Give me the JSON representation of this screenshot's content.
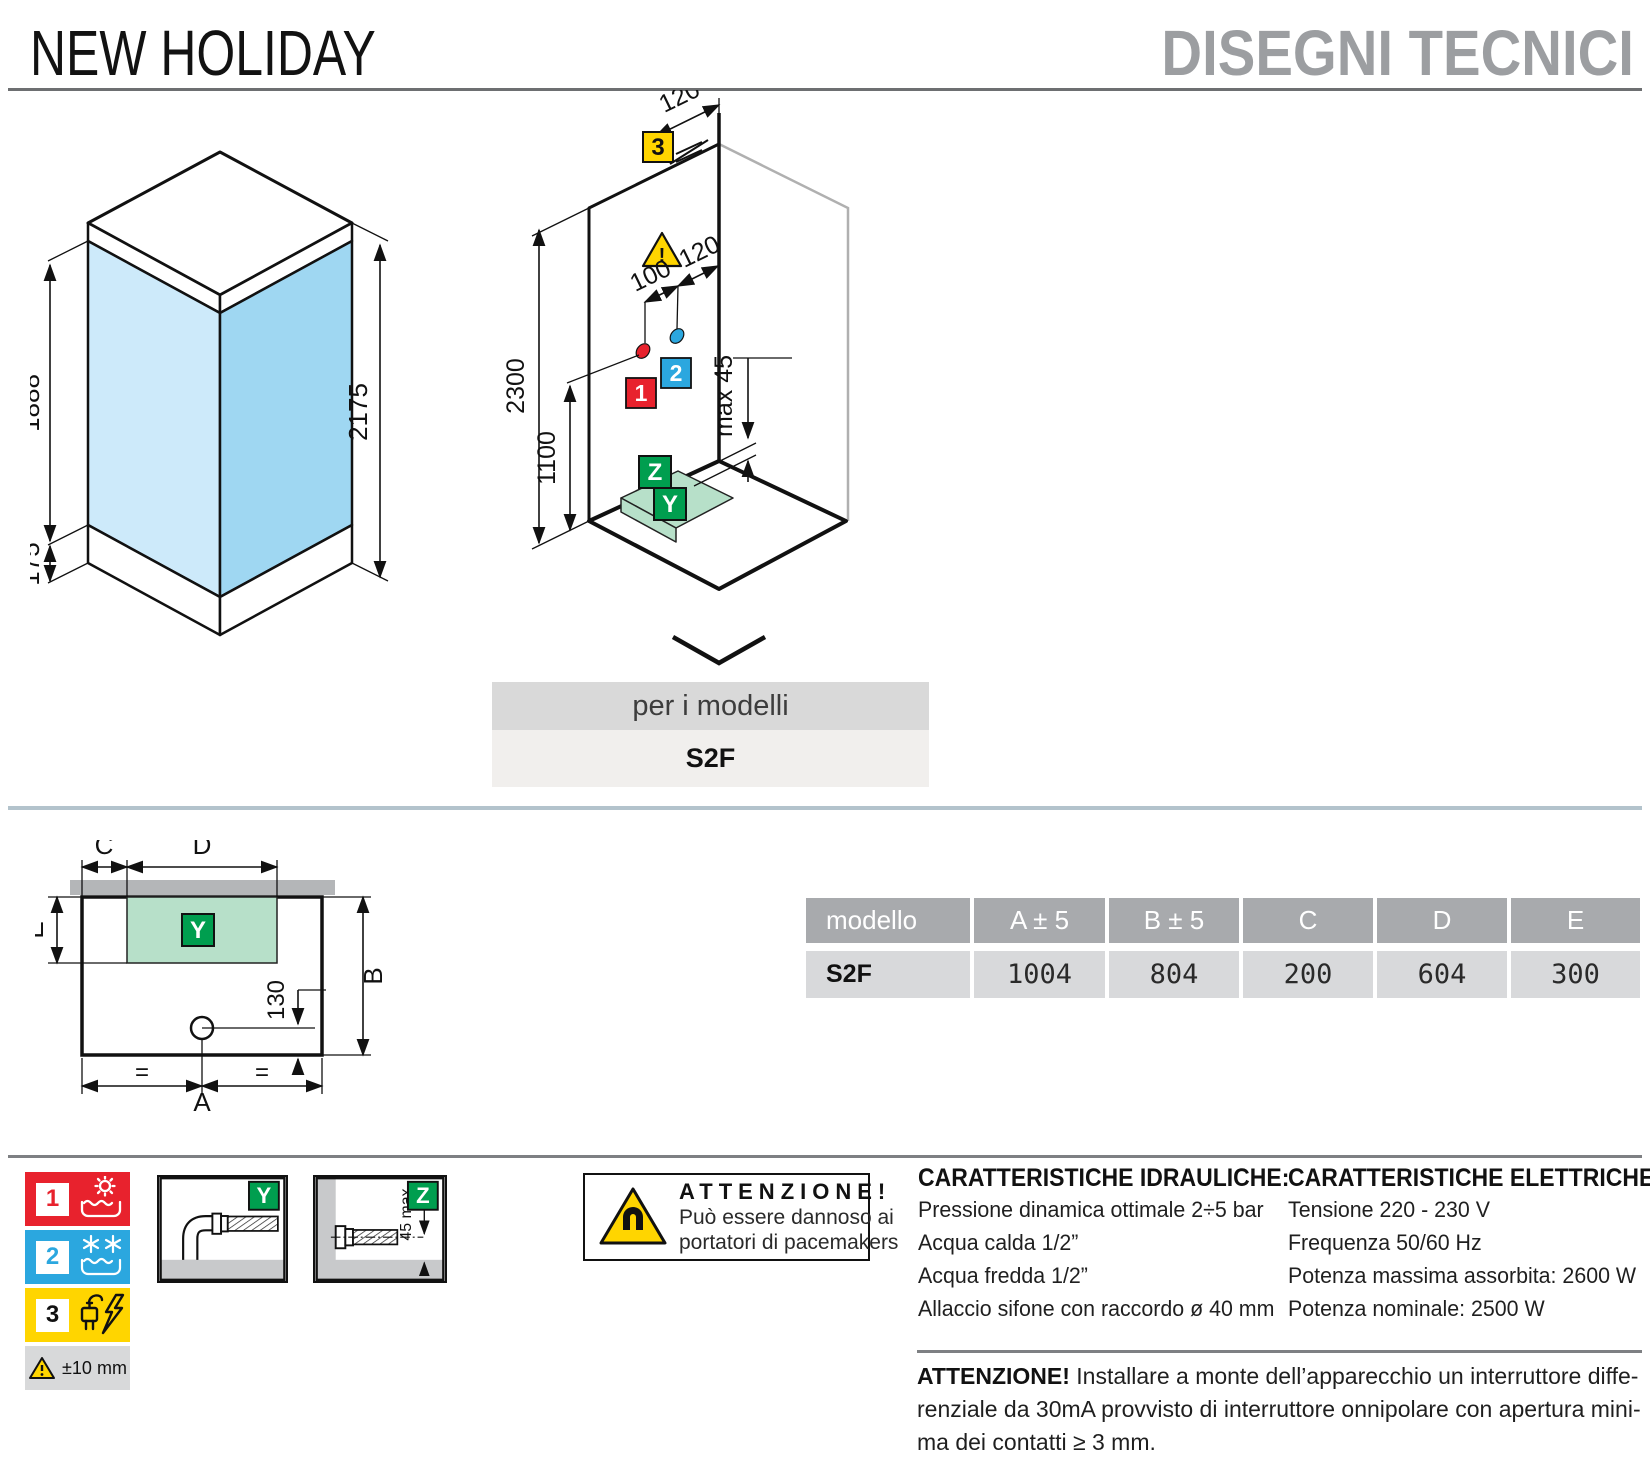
{
  "header": {
    "title": "NEW HOLIDAY",
    "subtitle": "DISEGNI TECNICI"
  },
  "iso_cabin": {
    "glass_height": "1888",
    "base_height": "175",
    "total_height": "2175"
  },
  "iso_wall": {
    "top_offset": "120",
    "spacing_hot": "100",
    "spacing_cold": "120",
    "wall_height": "2300",
    "mixer_height": "1100",
    "tray_gap": "max 45",
    "marker_hot": "1",
    "marker_cold": "2",
    "marker_power": "3",
    "marker_drain_wall": "Z",
    "marker_drain_floor": "Y",
    "warning_symbol": "!"
  },
  "models_band": {
    "label": "per i modelli",
    "model": "S2F"
  },
  "plan": {
    "a": "A",
    "b": "B",
    "c": "C",
    "d": "D",
    "e": "E",
    "drain_offset": "130",
    "equal_left": "=",
    "equal_right": "=",
    "y_marker": "Y"
  },
  "table": {
    "headers": [
      "modello",
      "A ± 5",
      "B ± 5",
      "C",
      "D",
      "E"
    ],
    "row": [
      "S2F",
      "1004",
      "804",
      "200",
      "604",
      "300"
    ]
  },
  "legend": {
    "hot_id": "1",
    "cold_id": "2",
    "power_id": "3",
    "tolerance": "±10 mm"
  },
  "drains": {
    "y_label": "Y",
    "z_label": "Z",
    "z_dim": "45 max"
  },
  "magnet_warning": {
    "title": "ATTENZIONE!",
    "line1": "Può essere dannoso ai",
    "line2": "portatori di pacemakers"
  },
  "hydraulic": {
    "title": "CARATTERISTICHE IDRAULICHE:",
    "lines": [
      "Pressione dinamica ottimale 2÷5 bar",
      "Acqua calda 1/2”",
      "Acqua fredda 1/2”",
      "Allaccio sifone con raccordo ø 40 mm"
    ]
  },
  "electric": {
    "title": "CARATTERISTICHE ELETTRICHE:",
    "lines": [
      "Tensione 220 - 230 V",
      "Frequenza 50/60 Hz",
      "Potenza massima assorbita: 2600 W",
      "Potenza nominale: 2500 W"
    ]
  },
  "footer_warning": {
    "title": "ATTENZIONE!",
    "line1": "Installare a monte dell’apparecchio un interruttore diffe-",
    "line2": "renziale da 30mA provvisto di interruttore onnipolare con apertura mini-",
    "line3": "ma dei contatti ≥ 3 mm."
  },
  "colors": {
    "hot": "#e8222d",
    "cold": "#2ba7df",
    "power": "#ffd500",
    "drain_green": "#009e4f",
    "tray_green": "#b7e0c9",
    "glass_light": "#cdeafa",
    "glass_dark": "#9fd7f2"
  }
}
